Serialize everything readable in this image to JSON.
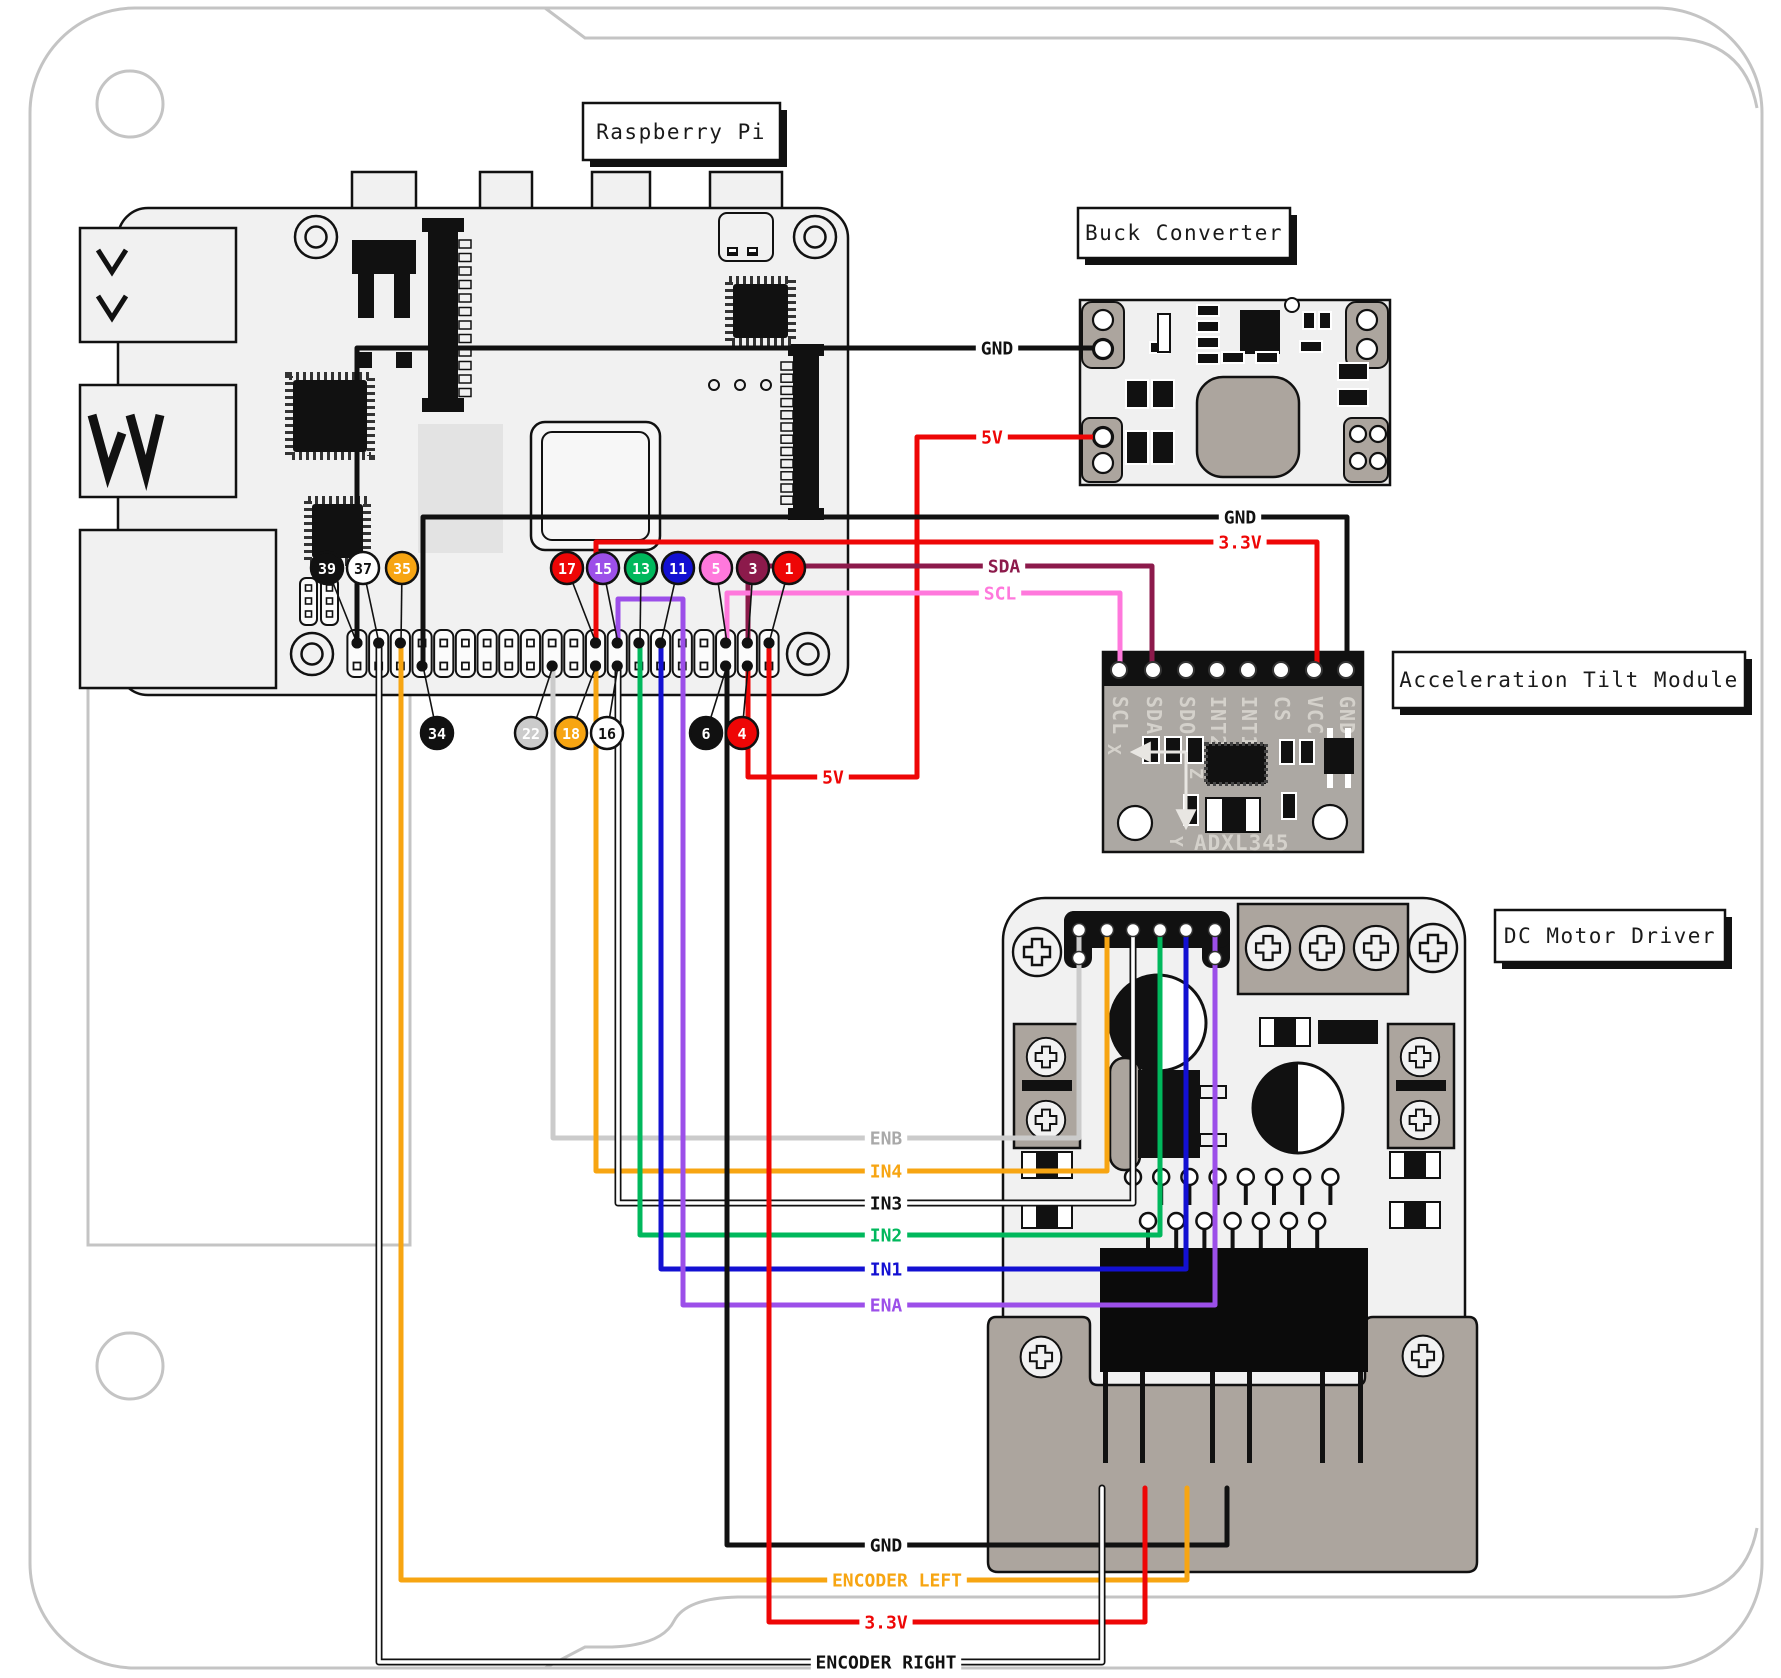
{
  "titles": {
    "raspberry_pi": "Raspberry Pi",
    "buck_converter": "Buck Converter",
    "tilt_module": "Acceleration Tilt Module",
    "motor_driver": "DC Motor Driver"
  },
  "adxl": {
    "pin_labels": [
      "SCL",
      "SDA",
      "SDO",
      "INT2",
      "INT1",
      "CS",
      "VCC",
      "GND"
    ],
    "chip_text": "ADXL345",
    "axes": [
      "X",
      "Y",
      "Z"
    ]
  },
  "colors": {
    "red": "#EE0606",
    "orange": "#F7A512",
    "green": "#00B85C",
    "blue": "#1310D2",
    "purple": "#9C4FE9",
    "pink": "#FF78DC",
    "maroon": "#8C1A4B",
    "gray": "#CBCBCB",
    "black": "#111111",
    "white": "#FFFFFF"
  },
  "gpio": {
    "used_top_cols": [
      1,
      2,
      3,
      12,
      13,
      14,
      15,
      18,
      19,
      20
    ],
    "used_bottom_cols": [
      4,
      10,
      12,
      13,
      18,
      19
    ]
  },
  "badges": [
    {
      "num": "39",
      "x": 327,
      "y": 568,
      "fill": "black",
      "text": "white",
      "hx": 357,
      "hy": 643
    },
    {
      "num": "37",
      "x": 363,
      "y": 568,
      "fill": "white",
      "text": "black",
      "hx": 379,
      "hy": 643
    },
    {
      "num": "35",
      "x": 402,
      "y": 568,
      "fill": "orange",
      "text": "white",
      "hx": 401,
      "hy": 643
    },
    {
      "num": "17",
      "x": 567,
      "y": 568,
      "fill": "red",
      "text": "white",
      "hx": 596,
      "hy": 643
    },
    {
      "num": "15",
      "x": 603,
      "y": 568,
      "fill": "purple",
      "text": "white",
      "hx": 618,
      "hy": 643
    },
    {
      "num": "13",
      "x": 641,
      "y": 568,
      "fill": "green",
      "text": "white",
      "hx": 640,
      "hy": 643
    },
    {
      "num": "11",
      "x": 678,
      "y": 568,
      "fill": "blue",
      "text": "white",
      "hx": 661,
      "hy": 643
    },
    {
      "num": "5",
      "x": 716,
      "y": 568,
      "fill": "pink",
      "text": "white",
      "hx": 727,
      "hy": 643
    },
    {
      "num": "3",
      "x": 753,
      "y": 568,
      "fill": "maroon",
      "text": "white",
      "hx": 748,
      "hy": 643
    },
    {
      "num": "1",
      "x": 789,
      "y": 568,
      "fill": "red",
      "text": "white",
      "hx": 769,
      "hy": 643
    },
    {
      "num": "34",
      "x": 437,
      "y": 733,
      "fill": "black",
      "text": "white",
      "hx": 423,
      "hy": 666
    },
    {
      "num": "22",
      "x": 531,
      "y": 733,
      "fill": "gray",
      "text": "white",
      "hx": 553,
      "hy": 666
    },
    {
      "num": "18",
      "x": 571,
      "y": 733,
      "fill": "orange",
      "text": "white",
      "hx": 596,
      "hy": 666
    },
    {
      "num": "16",
      "x": 607,
      "y": 733,
      "fill": "white",
      "text": "black",
      "hx": 618,
      "hy": 666
    },
    {
      "num": "6",
      "x": 706,
      "y": 733,
      "fill": "black",
      "text": "white",
      "hx": 727,
      "hy": 666
    },
    {
      "num": "4",
      "x": 742,
      "y": 733,
      "fill": "red",
      "text": "white",
      "hx": 748,
      "hy": 666
    }
  ],
  "wires": [
    {
      "name": "gnd-to-buck",
      "color": "black",
      "points": [
        [
          357,
          643
        ],
        [
          357,
          348
        ],
        [
          1093,
          348
        ]
      ],
      "labels": [
        {
          "text": "GND",
          "x": 997,
          "y": 348,
          "color": "black"
        }
      ]
    },
    {
      "name": "5v-to-buck",
      "color": "red",
      "points": [
        [
          748,
          666
        ],
        [
          748,
          777
        ],
        [
          917,
          777
        ],
        [
          917,
          437
        ],
        [
          1103,
          437
        ]
      ],
      "labels": [
        {
          "text": "5V",
          "x": 833,
          "y": 777,
          "color": "red"
        },
        {
          "text": "5V",
          "x": 992,
          "y": 437,
          "color": "red"
        }
      ]
    },
    {
      "name": "gnd-to-tilt",
      "color": "black",
      "points": [
        [
          423,
          666
        ],
        [
          423,
          517
        ],
        [
          1347,
          517
        ],
        [
          1347,
          668
        ]
      ],
      "labels": [
        {
          "text": "GND",
          "x": 1240,
          "y": 517,
          "color": "black"
        }
      ]
    },
    {
      "name": "3v3-to-tilt",
      "color": "red",
      "points": [
        [
          596,
          643
        ],
        [
          596,
          542
        ],
        [
          1317,
          542
        ],
        [
          1317,
          668
        ]
      ],
      "labels": [
        {
          "text": "3.3V",
          "x": 1240,
          "y": 542,
          "color": "red"
        }
      ]
    },
    {
      "name": "sda",
      "color": "maroon",
      "points": [
        [
          748,
          643
        ],
        [
          748,
          566
        ],
        [
          1152,
          566
        ],
        [
          1152,
          668
        ]
      ],
      "labels": [
        {
          "text": "SDA",
          "x": 1004,
          "y": 566,
          "color": "maroon"
        }
      ]
    },
    {
      "name": "scl",
      "color": "pink",
      "points": [
        [
          727,
          643
        ],
        [
          727,
          593
        ],
        [
          1120,
          593
        ],
        [
          1120,
          668
        ]
      ],
      "labels": [
        {
          "text": "SCL",
          "x": 1000,
          "y": 593,
          "color": "pink"
        }
      ]
    },
    {
      "name": "enb",
      "color": "gray",
      "points": [
        [
          553,
          666
        ],
        [
          553,
          1138
        ],
        [
          1079,
          1138
        ],
        [
          1079,
          930
        ]
      ],
      "labels": [
        {
          "text": "ENB",
          "x": 886,
          "y": 1138,
          "color": "#A9A9A9"
        }
      ]
    },
    {
      "name": "in4",
      "color": "orange",
      "points": [
        [
          596,
          666
        ],
        [
          596,
          1171
        ],
        [
          1107,
          1171
        ],
        [
          1107,
          930
        ]
      ],
      "labels": [
        {
          "text": "IN4",
          "x": 886,
          "y": 1171,
          "color": "orange"
        }
      ]
    },
    {
      "name": "in3",
      "color": "white",
      "outlined": true,
      "points": [
        [
          618,
          666
        ],
        [
          618,
          1203
        ],
        [
          1133,
          1203
        ],
        [
          1133,
          930
        ]
      ],
      "labels": [
        {
          "text": "IN3",
          "x": 886,
          "y": 1203,
          "color": "black"
        }
      ]
    },
    {
      "name": "in2",
      "color": "green",
      "points": [
        [
          640,
          643
        ],
        [
          640,
          1235
        ],
        [
          1160,
          1235
        ],
        [
          1160,
          930
        ]
      ],
      "labels": [
        {
          "text": "IN2",
          "x": 886,
          "y": 1235,
          "color": "green"
        }
      ]
    },
    {
      "name": "in1",
      "color": "blue",
      "points": [
        [
          661,
          643
        ],
        [
          661,
          1269
        ],
        [
          1186,
          1269
        ],
        [
          1186,
          930
        ]
      ],
      "labels": [
        {
          "text": "IN1",
          "x": 886,
          "y": 1269,
          "color": "blue"
        }
      ]
    },
    {
      "name": "ena",
      "color": "purple",
      "points": [
        [
          618,
          643
        ],
        [
          618,
          599
        ],
        [
          683,
          599
        ],
        [
          683,
          1305
        ],
        [
          1215,
          1305
        ],
        [
          1215,
          930
        ]
      ],
      "labels": [
        {
          "text": "ENA",
          "x": 886,
          "y": 1305,
          "color": "purple"
        }
      ]
    },
    {
      "name": "gnd-to-driver",
      "color": "black",
      "points": [
        [
          727,
          666
        ],
        [
          727,
          1545
        ],
        [
          1227,
          1545
        ],
        [
          1227,
          1488
        ]
      ],
      "labels": [
        {
          "text": "GND",
          "x": 886,
          "y": 1545,
          "color": "black"
        }
      ]
    },
    {
      "name": "encoder-left",
      "color": "orange",
      "points": [
        [
          401,
          643
        ],
        [
          401,
          1580
        ],
        [
          1187,
          1580
        ],
        [
          1187,
          1488
        ]
      ],
      "labels": [
        {
          "text": "ENCODER LEFT",
          "x": 897,
          "y": 1580,
          "color": "orange"
        }
      ]
    },
    {
      "name": "3v3-to-driver",
      "color": "red",
      "points": [
        [
          769,
          643
        ],
        [
          769,
          1622
        ],
        [
          1145,
          1622
        ],
        [
          1145,
          1488
        ]
      ],
      "labels": [
        {
          "text": "3.3V",
          "x": 886,
          "y": 1622,
          "color": "red"
        }
      ]
    },
    {
      "name": "encoder-right",
      "color": "white",
      "outlined": true,
      "points": [
        [
          379,
          643
        ],
        [
          379,
          1662
        ],
        [
          1102,
          1662
        ],
        [
          1102,
          1488
        ]
      ],
      "labels": [
        {
          "text": "ENCODER RIGHT",
          "x": 886,
          "y": 1662,
          "color": "black"
        }
      ]
    }
  ]
}
